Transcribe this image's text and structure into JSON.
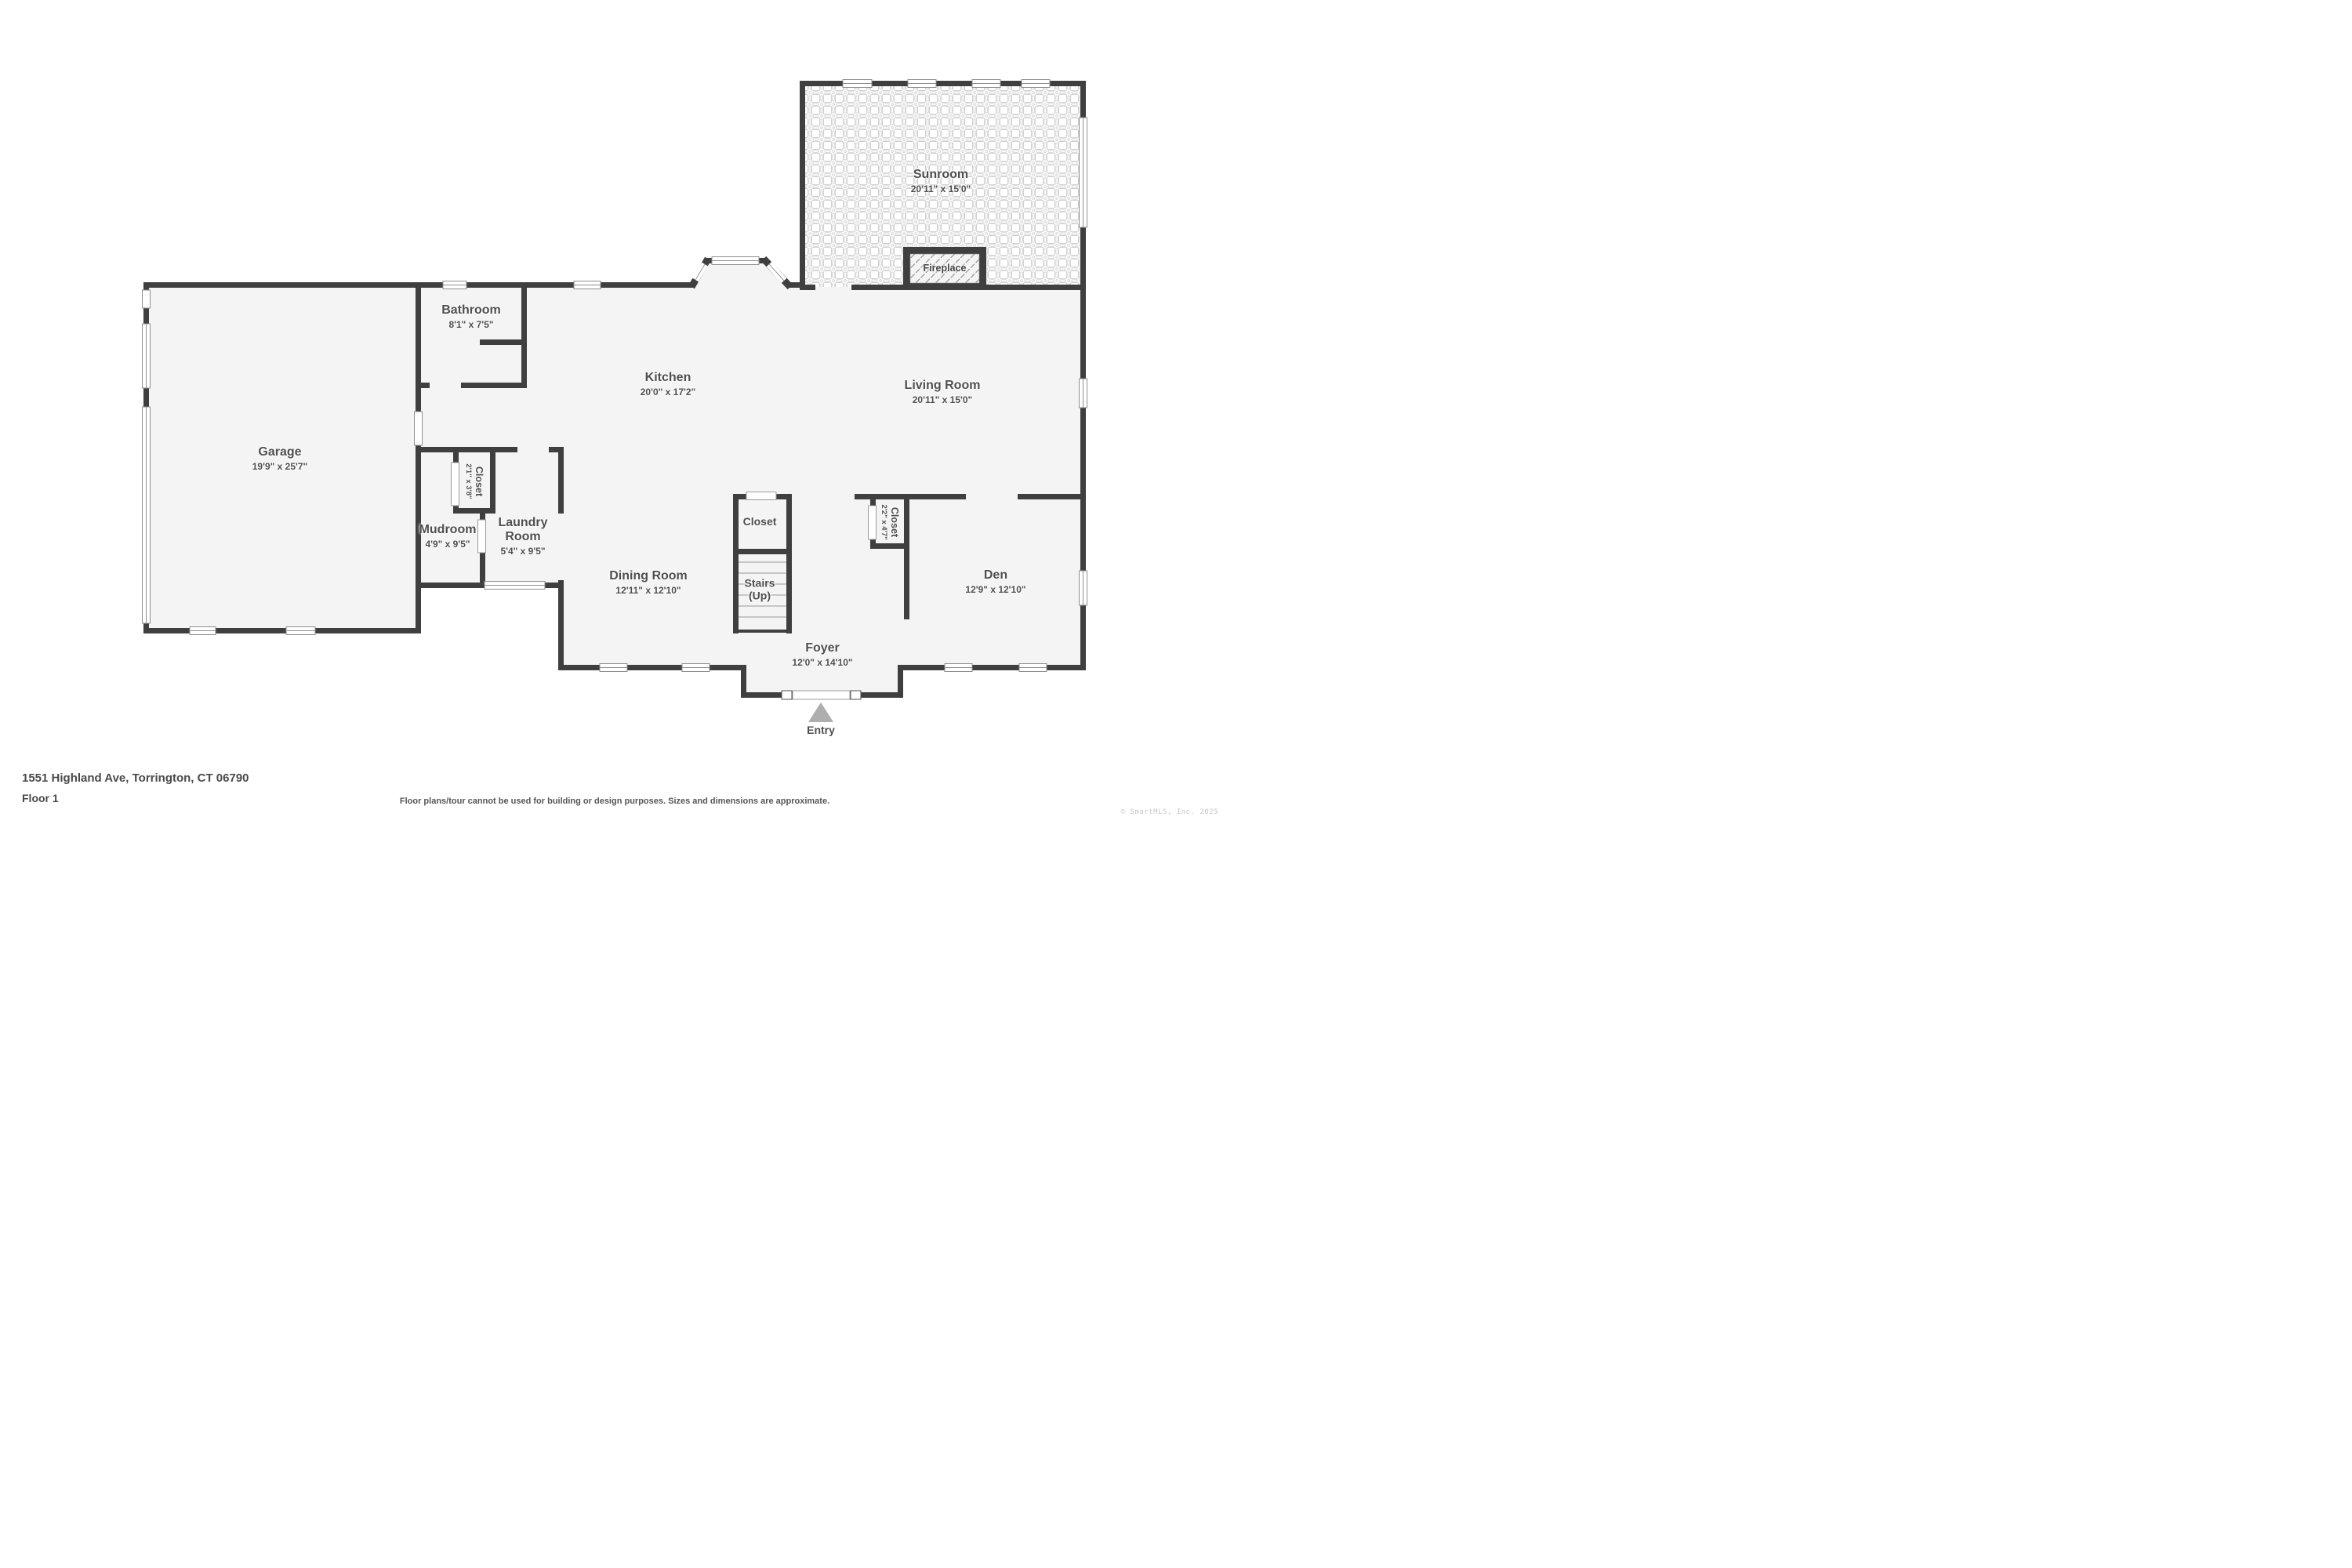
{
  "meta": {
    "address": "1551 Highland Ave, Torrington, CT 06790",
    "floor_label": "Floor 1",
    "disclaimer": "Floor plans/tour cannot be used for building or design purposes. Sizes and dimensions are approximate.",
    "copyright": "© SmartMLS, Inc. 2025"
  },
  "rooms": {
    "sunroom": {
      "name": "Sunroom",
      "dims": "20'11\" x 15'0\""
    },
    "fireplace": {
      "name": "Fireplace"
    },
    "bathroom": {
      "name": "Bathroom",
      "dims": "8'1\" x 7'5\""
    },
    "kitchen": {
      "name": "Kitchen",
      "dims": "20'0\" x 17'2\""
    },
    "living_room": {
      "name": "Living Room",
      "dims": "20'11\" x 15'0\""
    },
    "garage": {
      "name": "Garage",
      "dims": "19'9\" x 25'7\""
    },
    "closet_laundry": {
      "name": "Closet",
      "dims": "2'1\" x 3'8\""
    },
    "mudroom": {
      "name": "Mudroom",
      "dims": "4'9\" x 9'5\""
    },
    "laundry_room": {
      "name": "Laundry Room",
      "dims": "5'4\" x 9'5\""
    },
    "dining_room": {
      "name": "Dining Room",
      "dims": "12'11\" x 12'10\""
    },
    "closet_foyer": {
      "name": "Closet"
    },
    "stairs": {
      "name": "Stairs (Up)"
    },
    "closet_den": {
      "name": "Closet",
      "dims": "2'2\" x 4'7\""
    },
    "den": {
      "name": "Den",
      "dims": "12'9\" x 12'10\""
    },
    "foyer": {
      "name": "Foyer",
      "dims": "12'0\" x 14'10\""
    },
    "entry": {
      "name": "Entry"
    }
  }
}
